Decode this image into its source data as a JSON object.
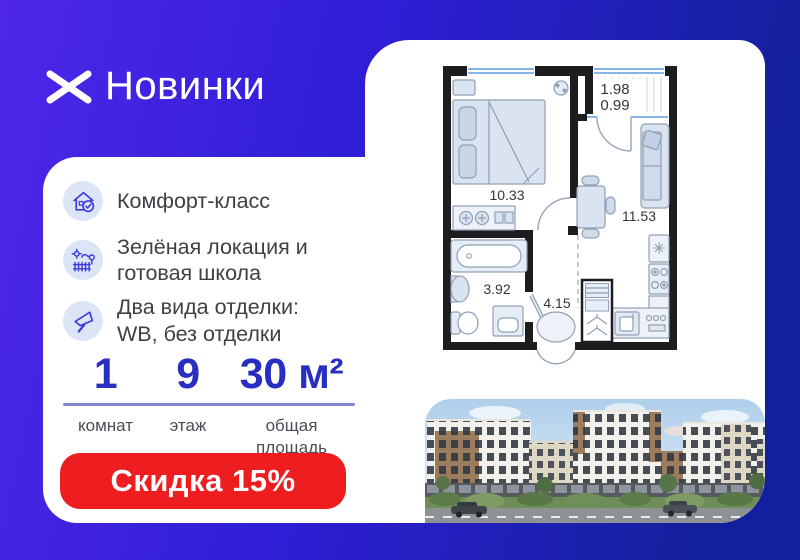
{
  "colors": {
    "bg_start": "#4e27ea",
    "bg_mid": "#2f1ed6",
    "bg_end": "#13209d",
    "accent_red": "#ee1d1f",
    "stat_blue": "#282ec2",
    "divider": "#8486d2",
    "icon_circle_bg": "#dce5f5",
    "icon_stroke": "#3d3de0",
    "wall": "#1d1d1f",
    "furniture_fill": "#dae3f0",
    "furniture_stroke": "#8fa0b5",
    "window_blue": "#85b6ea"
  },
  "logo": {
    "name": "Новинки"
  },
  "features": {
    "items": [
      {
        "icon": "house-check-icon",
        "text": "Комфорт-класс"
      },
      {
        "icon": "garden-icon",
        "text": "Зелёная локация и готовая школа"
      },
      {
        "icon": "trowel-icon",
        "text": "Два вида отделки: WB, без отделки"
      }
    ]
  },
  "stats": {
    "items": [
      {
        "value": "1",
        "label": "комнат"
      },
      {
        "value": "9",
        "label": "этаж"
      },
      {
        "value": "30 м²",
        "label": "общая площадь"
      }
    ]
  },
  "discount": {
    "label": "Скидка 15%"
  },
  "floorplan": {
    "bedroom_area": "10.33",
    "living_area": "11.53",
    "bathroom_area": "3.92",
    "hall_area": "4.15",
    "balcony_width": "1.98",
    "balcony_area": "0.99"
  }
}
